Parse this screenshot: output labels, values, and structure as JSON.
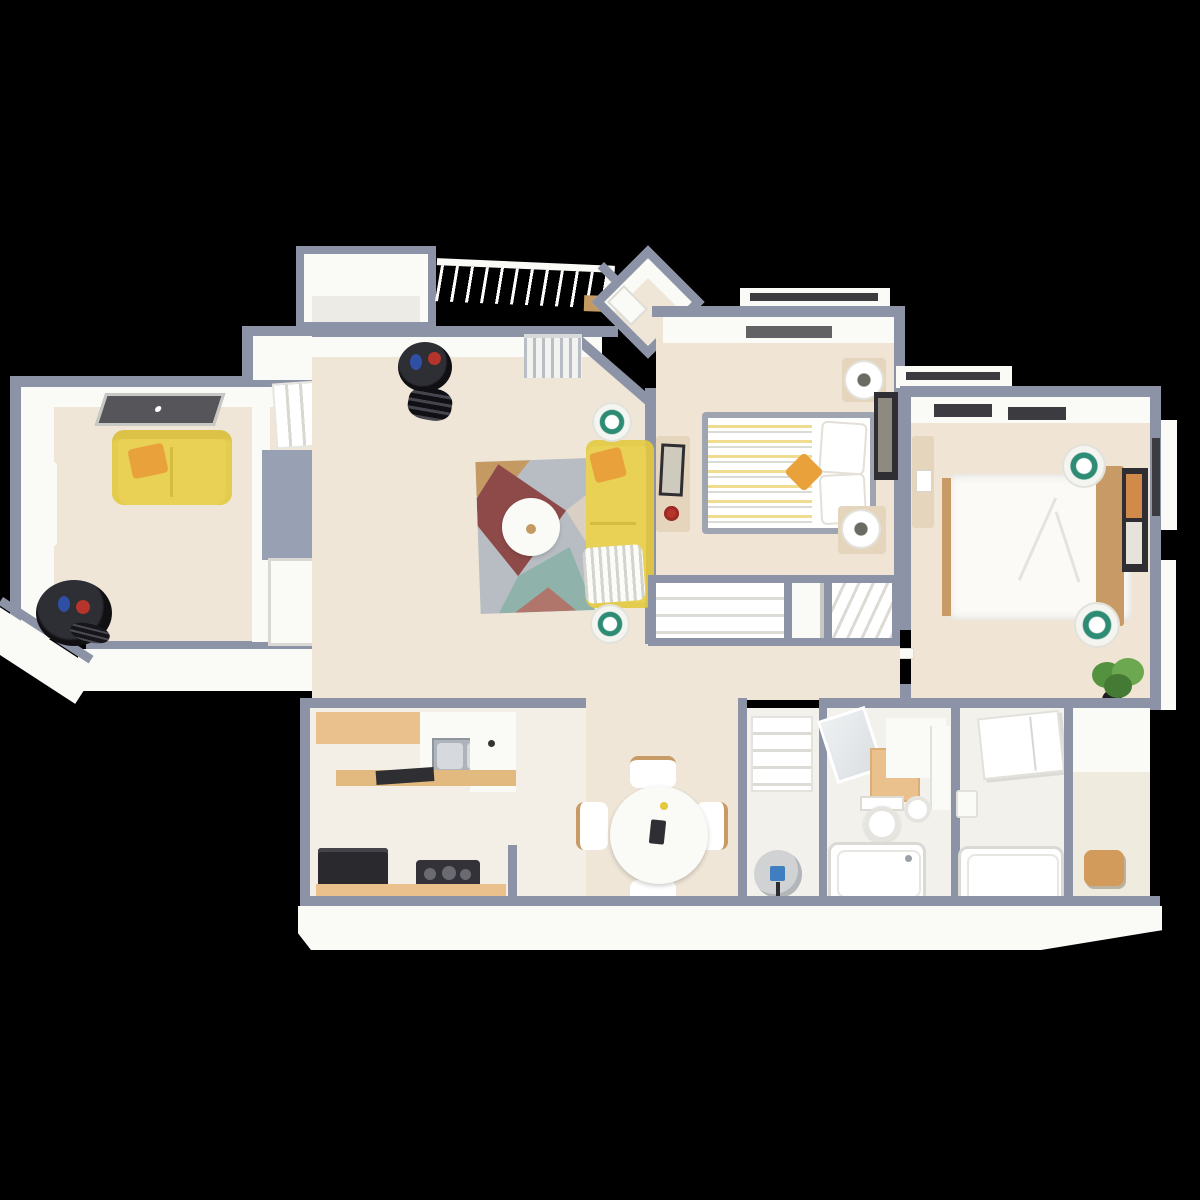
{
  "scene": {
    "description": "3D rendered top-down isometric floor plan of a two-bedroom, two-bath apartment, shown on a solid black background",
    "background": "#000000",
    "text_on_screen": []
  },
  "palette": {
    "background": "#000000",
    "wall": "#8C93A7",
    "wall_panel": "#98A0B4",
    "white": "#FAFAF7",
    "white_soft": "#ECEBE6",
    "floor_main": "#EFE6D7",
    "floor_bedroom": "#F0E5D4",
    "floor_kitchen": "#F4EFE6",
    "floor_bath": "#F3F1EC",
    "wood": "#EAC18D",
    "wood_dark": "#C89B66",
    "sofa_yellow": "#E8D155",
    "pillow_orange": "#E9A23B",
    "rug_base": "#B7BDC2",
    "rug_maroon": "#8E4A49",
    "rug_teal": "#8FB3AA",
    "rug_tan": "#C49A62",
    "rug_cream": "#D9D0C3",
    "appliance_dark": "#2A2A2E",
    "metal": "#AEB4BA",
    "lamp_teal": "#2E8B74",
    "plant_green": "#55923F",
    "accent_red": "#B5342C",
    "accent_blue": "#2E4FA3",
    "art_dark": "#2F2F33",
    "window_dark": "#3C3C40"
  },
  "rooms": [
    {
      "id": "den",
      "name": "den-second-living-area",
      "furniture": [
        "yellow loveseat with orange pillow",
        "black drum side table with red and blue decor",
        "angled wall window panel",
        "two floor-level windows on west wall"
      ]
    },
    {
      "id": "stair-closet",
      "name": "stair-and-closet-nook",
      "furniture": [
        "staircase",
        "blue-gray closet volume",
        "white closet door"
      ]
    },
    {
      "id": "storage-bump",
      "name": "exterior-storage-closet",
      "furniture": []
    },
    {
      "id": "balcony",
      "name": "balcony",
      "furniture": [
        "white picket railing",
        "tan door mat"
      ]
    },
    {
      "id": "entry",
      "name": "diagonal-entry-foyer",
      "furniture": [
        "white front door leaf"
      ]
    },
    {
      "id": "living-room",
      "name": "living-room",
      "furniture": [
        "yellow sofa with orange pillow and white knit throw",
        "geometric area rug (maroon, teal, tan, gray)",
        "round white coffee table",
        "two floor lamps with teal tops",
        "black cylinder storage rack",
        "chrome radiator at balcony wall"
      ]
    },
    {
      "id": "bedroom-1",
      "name": "bedroom-one",
      "furniture": [
        "bed with gray frame, yellow striped duvet, white pillows, orange accent pillow",
        "two beige nightstands with lamps",
        "beige dresser with red decor",
        "dark wall art",
        "window bay at top wall"
      ]
    },
    {
      "id": "bedroom-2",
      "name": "bedroom-two",
      "furniture": [
        "white bed with wood side rail and wood headboard",
        "two round white lamp tables with teal tops",
        "narrow beige dresser",
        "dark framed wall art",
        "potted green plant",
        "two dark window slots on top wall",
        "side window bay"
      ]
    },
    {
      "id": "hallway",
      "name": "hallway-with-closets",
      "furniture": [
        "wide reach-in closet",
        "narrow closet",
        "linen shelves"
      ]
    },
    {
      "id": "kitchen",
      "name": "kitchen",
      "furniture": [
        "wood-top counter",
        "stainless double-basin sink",
        "white peninsula",
        "wood service bar with black cutting board",
        "black oven",
        "black cooktop",
        "wood-top lower counter"
      ]
    },
    {
      "id": "dining",
      "name": "dining-area",
      "furniture": [
        "round white dining table",
        "four white chairs with wood legs",
        "small items on tabletop"
      ]
    },
    {
      "id": "utility",
      "name": "utility-closet",
      "furniture": [
        "white shelving unit",
        "gray water heater with blue panel"
      ]
    },
    {
      "id": "bathroom-1",
      "name": "bathroom-one",
      "furniture": [
        "leaning vanity mirror",
        "wood cabinet",
        "white counter",
        "toilet",
        "bathtub"
      ]
    },
    {
      "id": "bathroom-2",
      "name": "bathroom-two",
      "furniture": [
        "angled white wall cabinet",
        "small white sink",
        "bathtub"
      ]
    },
    {
      "id": "walk-in-closet",
      "name": "walk-in-closet",
      "furniture": [
        "wood stool"
      ]
    }
  ]
}
